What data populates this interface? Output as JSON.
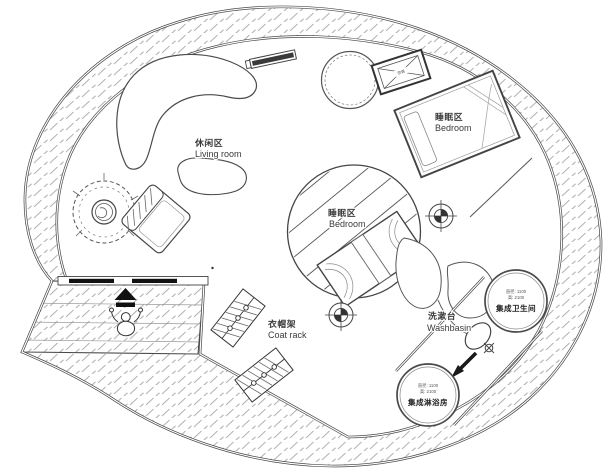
{
  "colors": {
    "line": "#4a4a4a",
    "hatch": "#b4b4b4",
    "text": "#3a3a3a",
    "solid_black": "#111111",
    "background": "#ffffff"
  },
  "areas": {
    "living_room": {
      "zh": "休闲区",
      "en": "Living room"
    },
    "bedroom_upper": {
      "zh": "睡眠区",
      "en": "Bedroom"
    },
    "bedroom_center": {
      "zh": "睡眠区",
      "en": "Bedroom"
    },
    "coat_rack": {
      "zh": "衣帽架",
      "en": "Coat rack"
    },
    "washbasin": {
      "zh": "洗漱台",
      "en": "Washbasin"
    }
  },
  "pods": {
    "toilet": {
      "spec_diameter": "直径: 1100",
      "spec_height": "高: 2100",
      "name": "集成卫生间"
    },
    "shower": {
      "spec_diameter": "直径: 1100",
      "spec_height": "高: 2100",
      "name": "集成淋浴房"
    }
  },
  "equipment": {
    "ac_label": "空调"
  },
  "icons": [
    "potted-plant-icon",
    "lounge-chair-icon",
    "crescent-sofa-icon",
    "kidney-table-icon",
    "window-strip-icon",
    "round-table-icon",
    "ac-crossed-box-icon",
    "bed-icon",
    "survey-marker-icon",
    "leaf-decor-icon",
    "basin-icon",
    "direction-arrow-icon",
    "entry-arrow-icon",
    "person-icon",
    "coat-rack-icon",
    "sliding-door-icon"
  ]
}
